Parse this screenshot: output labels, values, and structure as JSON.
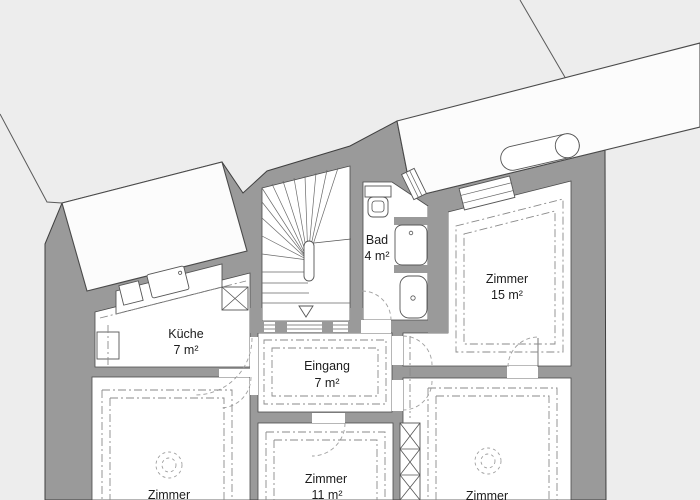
{
  "plan": {
    "colors": {
      "background": "#ededed",
      "wall": "#9a9a9a",
      "floor": "#ffffff",
      "neighbor": "#fcfcfc",
      "line": "#3f3f3f"
    },
    "rooms": [
      {
        "id": "kueche",
        "label": "Küche",
        "area": "7 m²"
      },
      {
        "id": "bad",
        "label": "Bad",
        "area": "4 m²"
      },
      {
        "id": "zimmer-15",
        "label": "Zimmer",
        "area": "15 m²"
      },
      {
        "id": "eingang",
        "label": "Eingang",
        "area": "7 m²"
      },
      {
        "id": "zimmer-11",
        "label": "Zimmer",
        "area": "11 m²"
      },
      {
        "id": "zimmer-bottom-left",
        "label": "Zimmer",
        "area": ""
      },
      {
        "id": "zimmer-bottom-right",
        "label": "Zimmer",
        "area": ""
      }
    ]
  }
}
